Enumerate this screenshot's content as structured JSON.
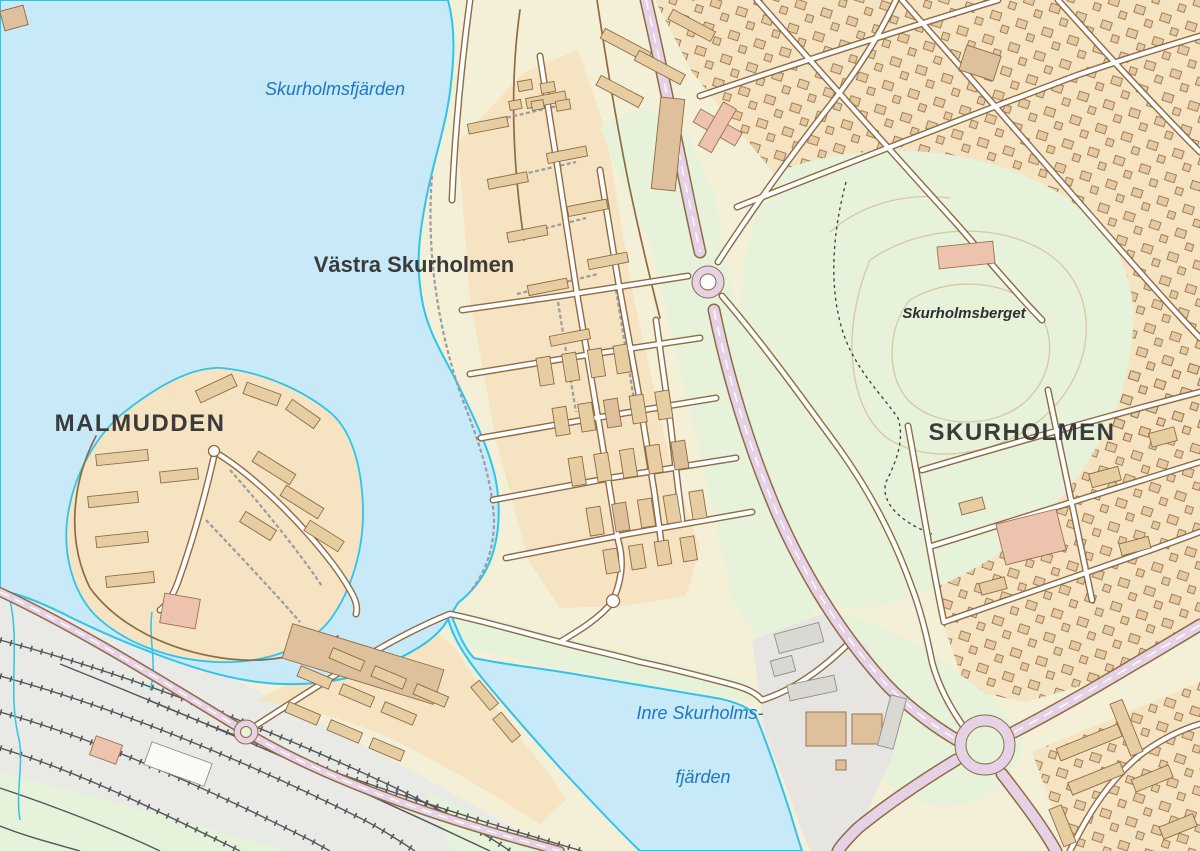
{
  "map": {
    "labels": {
      "water_main": "Skurholmsfjärden",
      "district_west": "Västra Skurholmen",
      "district_malmudden": "MALMUDDEN",
      "hill": "Skurholmsberget",
      "district_skurholmen": "SKURHOLMEN",
      "water_inner_line1": "Inre Skurholms-",
      "water_inner_line2": "fjärden"
    },
    "colors": {
      "water": "#C8E9F7",
      "shoreline": "#2EC4EB",
      "land": "#F4F0D8",
      "residential": "#F5E3C1",
      "park": "#E6F2D9",
      "industrial_gray": "#E9E9E5",
      "building": "#E7CDA2",
      "building_outline": "#8F6B43",
      "building_accent_pink": "#EEC3AE",
      "building_gray": "#D9D8D3",
      "road_major": "#E6D2E6",
      "road_casing": "#8F6B43",
      "road_minor": "#FFFFFF",
      "railway": "#55565A",
      "contour": "#D9C7A2",
      "label_water": "#1C78C0",
      "label_district": "#3B3B3B"
    }
  }
}
